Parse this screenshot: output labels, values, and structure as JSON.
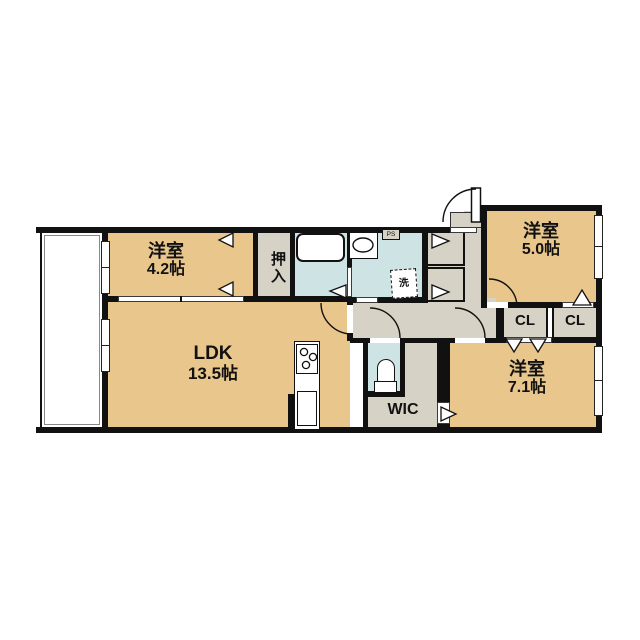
{
  "floorplan": {
    "rooms": {
      "western_room_42": {
        "name": "洋室",
        "size": "4.2帖"
      },
      "oshiire": {
        "name": "押入"
      },
      "ldk": {
        "name": "LDK",
        "size": "13.5帖"
      },
      "western_room_50": {
        "name": "洋室",
        "size": "5.0帖"
      },
      "western_room_71": {
        "name": "洋室",
        "size": "7.1帖"
      },
      "wic": {
        "name": "WIC"
      },
      "closet_left": {
        "name": "CL"
      },
      "closet_right": {
        "name": "CL"
      },
      "pipe_space": {
        "name": "PS"
      },
      "laundry": {
        "name": "洗"
      }
    },
    "colors": {
      "room": "#E9C78C",
      "hall": "#D6D2C5",
      "wet_area": "#CEE4E4",
      "wall": "#111111",
      "background": "#FFFFFF"
    }
  }
}
